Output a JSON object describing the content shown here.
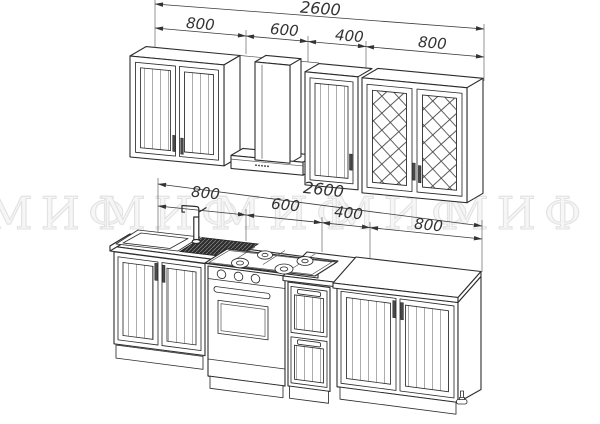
{
  "watermark": {
    "instances": [
      "МИФ",
      "МИФ",
      "МИФ",
      "МИФ",
      "МИФ"
    ]
  },
  "dimensions": {
    "upper": {
      "total": "2600",
      "segments": [
        "800",
        "600",
        "400",
        "800"
      ]
    },
    "lower": {
      "total": "2600",
      "segments": [
        "800",
        "600",
        "400",
        "800"
      ]
    }
  },
  "colors": {
    "line": "#2d2d2d",
    "dim_text": "#333333",
    "watermark_fill": "#f6f6f6",
    "watermark_stroke": "#e2e2e2",
    "background": "#ffffff"
  }
}
